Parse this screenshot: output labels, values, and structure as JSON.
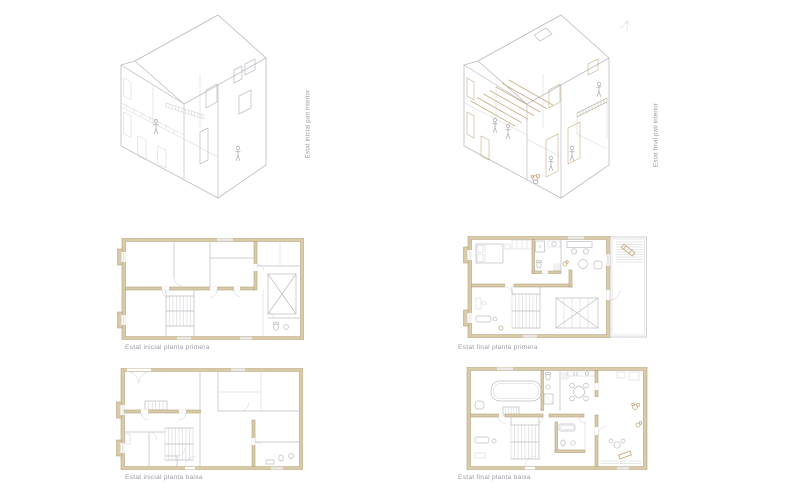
{
  "sheet": {
    "background": "#ffffff"
  },
  "colors": {
    "wall_fill": "#d9cba9",
    "wall_stroke": "#b3a27c",
    "accent_tan": "#c6ac80",
    "line_mid": "#bcbcc5",
    "line_light": "#cfcfd6",
    "figure_gray": "#b4b4bd",
    "text_gray": "#9b9ba6"
  },
  "figures": {
    "axon_initial": {
      "label": "Estat inicial pati interior"
    },
    "axon_final": {
      "label": "Estat final pati interior"
    },
    "plan_first_initial": {
      "caption": "Estat inicial planta primera"
    },
    "plan_first_final": {
      "caption": "Estat final planta primera"
    },
    "plan_ground_initial": {
      "caption": "Estat inicial planta baixa"
    },
    "plan_ground_final": {
      "caption": "Estat final planta baixa"
    }
  }
}
